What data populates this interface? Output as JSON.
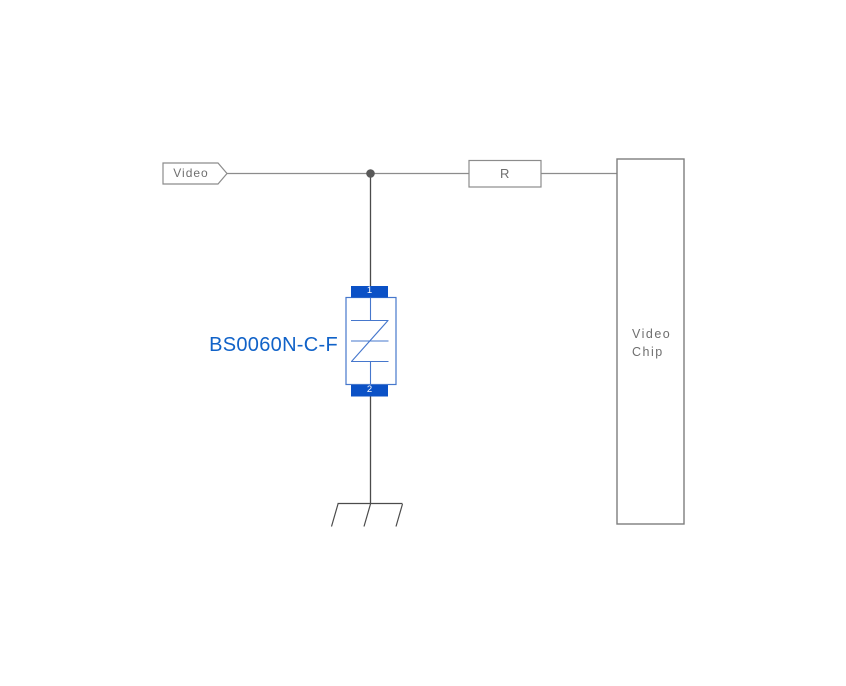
{
  "schematic": {
    "net_label": "Video",
    "resistor": {
      "label": "R"
    },
    "chip": {
      "line1": "Video",
      "line2": "Chip"
    },
    "component": {
      "label": "BS0060N-C-F",
      "pin1": "1",
      "pin2": "2"
    },
    "colors": {
      "wire_gray": "#8c8c8c",
      "wire_dark": "#4b4b4b",
      "junction_dot": "#595959",
      "pad_blue": "#0b51c6",
      "symbol_blue": "#4677cc",
      "label_blue": "#1062c8",
      "text_gray": "#6f6f6f",
      "box_border_gray": "#858585"
    }
  }
}
